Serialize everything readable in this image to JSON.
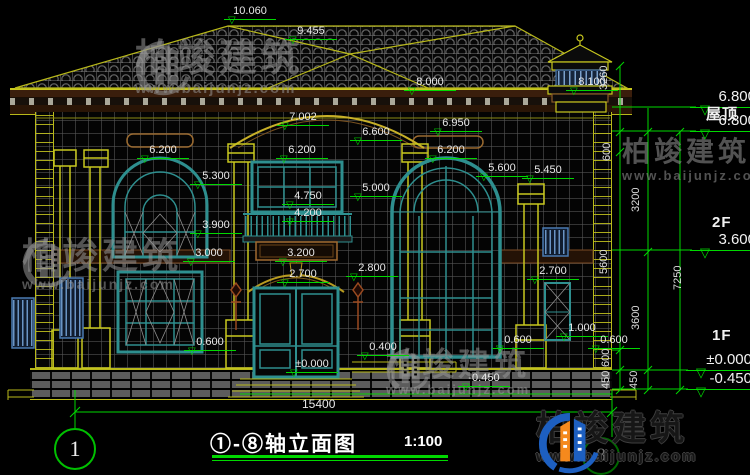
{
  "title": {
    "text": "①-⑧轴立面图",
    "scale": "1:100"
  },
  "axis_markers": {
    "left": "1",
    "right": "8"
  },
  "watermark": {
    "brand": "柏竣建筑",
    "url": "www.baijunjz.com"
  },
  "colors": {
    "dim_green": "#00d800",
    "line_yellow": "#b8b81a",
    "window_teal": "#2e8f8f",
    "louver_blue": "#4a7ab0",
    "brick_gray": "#5c5c5c",
    "watermark_gray": "#969696",
    "logo_blue": "#1d5fc0",
    "logo_orange": "#f5891d"
  },
  "labels": [
    {
      "t": "10.060",
      "x": 224,
      "y": 5,
      "c": "lvl",
      "n": "level-ridge"
    },
    {
      "t": "9.455",
      "x": 285,
      "y": 25,
      "c": "lvl",
      "n": "level-hip"
    },
    {
      "t": "8.000",
      "x": 404,
      "y": 76,
      "c": "lvl",
      "n": "level-eave"
    },
    {
      "t": "8.100",
      "x": 566,
      "y": 76,
      "c": "lvl",
      "n": "level-chimney"
    },
    {
      "t": "7.002",
      "x": 277,
      "y": 111,
      "c": "lvl",
      "n": "level-arch-apex"
    },
    {
      "t": "6.950",
      "x": 430,
      "y": 117,
      "c": "lvl",
      "n": "level-cornice"
    },
    {
      "t": "6.600",
      "x": 350,
      "y": 126,
      "c": "lvl",
      "n": "level-trim"
    },
    {
      "t": "6.200",
      "x": 137,
      "y": 144,
      "c": "lvl",
      "n": "level-window-top-left"
    },
    {
      "t": "6.200",
      "x": 276,
      "y": 144,
      "c": "lvl",
      "n": "level-window-top-center"
    },
    {
      "t": "6.200",
      "x": 425,
      "y": 144,
      "c": "lvl",
      "n": "level-window-top-right"
    },
    {
      "t": "5.600",
      "x": 476,
      "y": 162,
      "c": "lvl",
      "n": "level-arch-spring"
    },
    {
      "t": "5.450",
      "x": 522,
      "y": 164,
      "c": "lvl",
      "n": "level-capital-right"
    },
    {
      "t": "5.300",
      "x": 190,
      "y": 170,
      "c": "lvl",
      "n": "level-arch-spring-left"
    },
    {
      "t": "5.000",
      "x": 350,
      "y": 182,
      "c": "lvl",
      "n": "level-capital-bay"
    },
    {
      "t": "4.750",
      "x": 282,
      "y": 190,
      "c": "lvl",
      "n": "level-window-sill-center"
    },
    {
      "t": "4.200",
      "x": 282,
      "y": 207,
      "c": "lvl",
      "n": "level-balcony"
    },
    {
      "t": "3.900",
      "x": 190,
      "y": 219,
      "c": "lvl",
      "n": "level-window-sill-left"
    },
    {
      "t": "3.200",
      "x": 275,
      "y": 247,
      "c": "lvl",
      "n": "level-sign"
    },
    {
      "t": "3.000",
      "x": 183,
      "y": 247,
      "c": "lvl",
      "n": "level-1f-window-top"
    },
    {
      "t": "2.700",
      "x": 277,
      "y": 268,
      "c": "lvl",
      "n": "level-door-arch"
    },
    {
      "t": "2.800",
      "x": 346,
      "y": 262,
      "c": "lvl",
      "n": "level-door-side"
    },
    {
      "t": "2.700",
      "x": 527,
      "y": 265,
      "c": "lvl",
      "n": "level-small-window-top"
    },
    {
      "t": "0.600",
      "x": 184,
      "y": 336,
      "c": "lvl",
      "n": "level-1f-sill-left"
    },
    {
      "t": "0.400",
      "x": 357,
      "y": 341,
      "c": "lvl",
      "n": "level-platform"
    },
    {
      "t": "0.600",
      "x": 492,
      "y": 334,
      "c": "lvl",
      "n": "level-1f-sill-right"
    },
    {
      "t": "1.000",
      "x": 556,
      "y": 322,
      "c": "lvl",
      "n": "level-small-window-sill"
    },
    {
      "t": "0.600",
      "x": 588,
      "y": 334,
      "c": "lvl",
      "n": "level-base-right"
    },
    {
      "t": "±0.000",
      "x": 286,
      "y": 358,
      "c": "lvl",
      "n": "level-ground-door"
    },
    {
      "t": "-0.450",
      "x": 458,
      "y": 372,
      "c": "lvl",
      "n": "level-grade"
    },
    {
      "t": "6.800",
      "x": 690,
      "y": 88,
      "c": "lvlR",
      "n": "level-roof-right"
    },
    {
      "t": "屋顶",
      "x": 706,
      "y": 103,
      "c": "floor",
      "n": "floor-roof-label"
    },
    {
      "t": "6.800",
      "x": 690,
      "y": 112,
      "c": "lvlR",
      "n": "level-roof-right2"
    },
    {
      "t": "2F",
      "x": 712,
      "y": 214,
      "c": "floor",
      "n": "floor-2f-label"
    },
    {
      "t": "3.600",
      "x": 690,
      "y": 231,
      "c": "lvlR",
      "n": "level-2f"
    },
    {
      "t": "1F",
      "x": 712,
      "y": 327,
      "c": "floor",
      "n": "floor-1f-label"
    },
    {
      "t": "±0.000",
      "x": 686,
      "y": 351,
      "c": "lvlR",
      "n": "level-1f"
    },
    {
      "t": "-0.450",
      "x": 686,
      "y": 370,
      "c": "lvlR",
      "n": "level-grade-right"
    },
    {
      "t": "15400",
      "x": 302,
      "y": 397,
      "c": "dimh",
      "n": "dim-total-width"
    },
    {
      "t": "3260",
      "x": 610,
      "y": 78,
      "c": "dimv",
      "n": "dim-3260"
    },
    {
      "t": "600",
      "x": 613,
      "y": 149,
      "c": "dimv",
      "n": "dim-600-top"
    },
    {
      "t": "5600",
      "x": 610,
      "y": 262,
      "c": "dimv",
      "n": "dim-5600"
    },
    {
      "t": "600",
      "x": 612,
      "y": 355,
      "c": "dimv",
      "n": "dim-600-bottom"
    },
    {
      "t": "450",
      "x": 612,
      "y": 377,
      "c": "dimv",
      "n": "dim-450-inner"
    },
    {
      "t": "450",
      "x": 640,
      "y": 377,
      "c": "dimv",
      "n": "dim-450-outer"
    },
    {
      "t": "3200",
      "x": 642,
      "y": 200,
      "c": "dimv",
      "n": "dim-3200"
    },
    {
      "t": "3600",
      "x": 642,
      "y": 318,
      "c": "dimv",
      "n": "dim-3600"
    },
    {
      "t": "7250",
      "x": 684,
      "y": 278,
      "c": "dimv",
      "n": "dim-7250"
    }
  ]
}
